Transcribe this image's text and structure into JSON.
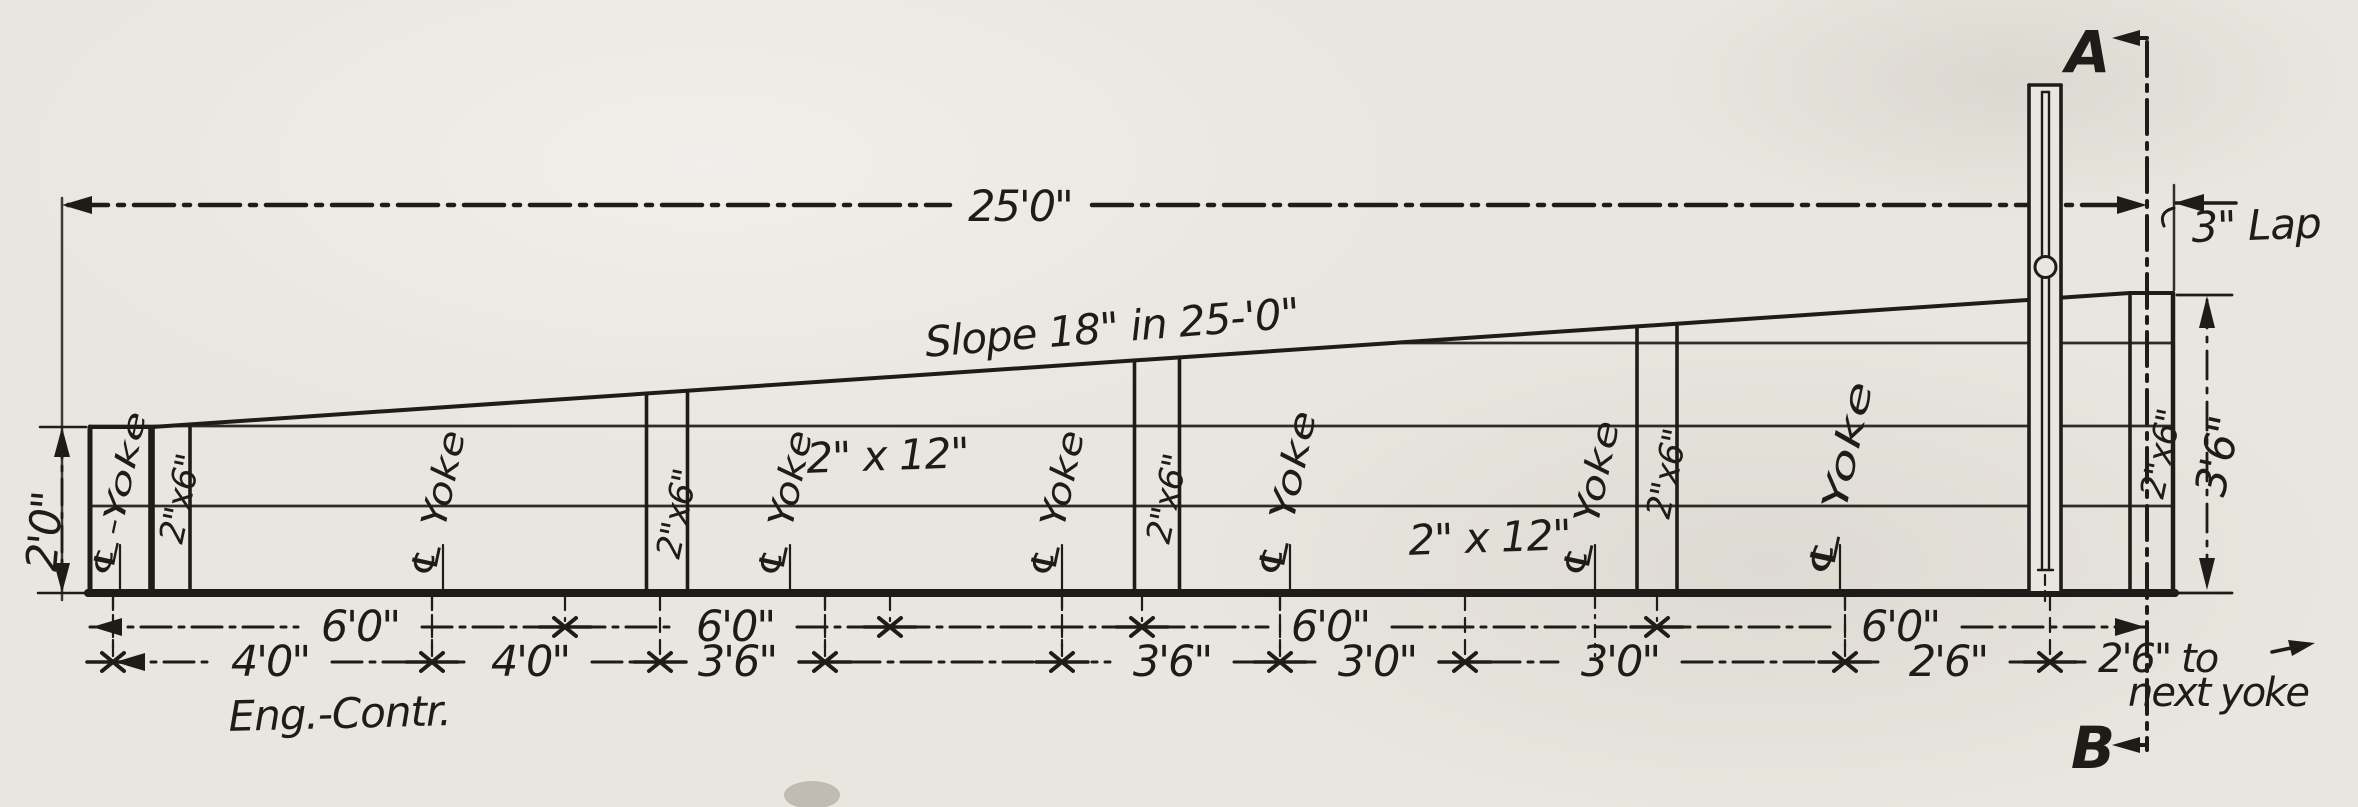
{
  "drawing": {
    "type": "engineering-elevation",
    "overall_dimension": "25'0\"",
    "lap_label": "3\" Lap",
    "slope_note": "Slope 18\" in 25-'0\"",
    "section_marker_top": "A",
    "section_marker_bottom": "B",
    "left_height_dim": "2'0\"",
    "right_height_dim": "3'6\"",
    "credit_note": "Eng.-Contr.",
    "next_yoke_line1": "2'6\" to",
    "next_yoke_line2": "next yoke",
    "plank_labels": [
      {
        "text": "2\" x 12\"",
        "x": 888,
        "y": 470
      },
      {
        "text": "2\" x 12\"",
        "x": 1490,
        "y": 552
      }
    ],
    "yoke_labels": [
      {
        "text": "℄-Yoke",
        "x": 120,
        "tick_x": 113,
        "label_len": 170,
        "small": true
      },
      {
        "text": "℄ Yoke",
        "x": 443,
        "tick_x": 432,
        "label_len": 150
      },
      {
        "text": "℄ Yoke",
        "x": 790,
        "tick_x": 825,
        "label_len": 150
      },
      {
        "text": "℄ Yoke",
        "x": 1062,
        "tick_x": 1062,
        "label_len": 150
      },
      {
        "text": "℄ Yoke",
        "x": 1290,
        "tick_x": 1280,
        "label_len": 170
      },
      {
        "text": "℄ Yoke",
        "x": 1595,
        "tick_x": 1595,
        "label_len": 160
      },
      {
        "text": "℄ Yoke",
        "x": 1840,
        "tick_x": 1845,
        "label_len": 200
      }
    ],
    "cleat_labels": [
      {
        "text": "2\"x6\"",
        "x": 170,
        "w": 40,
        "label_y": 545
      },
      {
        "text": "2\"x6\"",
        "x": 667,
        "w": 41,
        "label_y": 560
      },
      {
        "text": "2\"x6\"",
        "x": 1157,
        "w": 45,
        "label_y": 545
      },
      {
        "text": "2\"x6\"",
        "x": 1657,
        "w": 40,
        "label_y": 520
      },
      {
        "text": "2\"x6\"",
        "x": 2151,
        "w": 43,
        "label_y": 500
      }
    ],
    "dim_row_1": {
      "y": 627,
      "ticks": [
        565,
        890,
        1142,
        1657
      ],
      "start_x": 90,
      "end_x": 2147,
      "labels": [
        {
          "text": "6'0\"",
          "x": 360
        },
        {
          "text": "6'0\"",
          "x": 735
        },
        {
          "text": "6'0\"",
          "x": 1330
        },
        {
          "text": "6'0\"",
          "x": 1900
        }
      ]
    },
    "dim_row_2": {
      "y": 662,
      "ticks": [
        113,
        432,
        660,
        825,
        1062,
        1280,
        1465,
        1845,
        2050
      ],
      "labels": [
        {
          "text": "4'0\"",
          "x": 270
        },
        {
          "text": "4'0\"",
          "x": 530
        },
        {
          "text": "3'6\"",
          "x": 737
        },
        {
          "text": "3'6\"",
          "x": 1172
        },
        {
          "text": "3'0\"",
          "x": 1377
        },
        {
          "text": "3'0\"",
          "x": 1620
        },
        {
          "text": "2'6\"",
          "x": 1948
        }
      ]
    }
  }
}
